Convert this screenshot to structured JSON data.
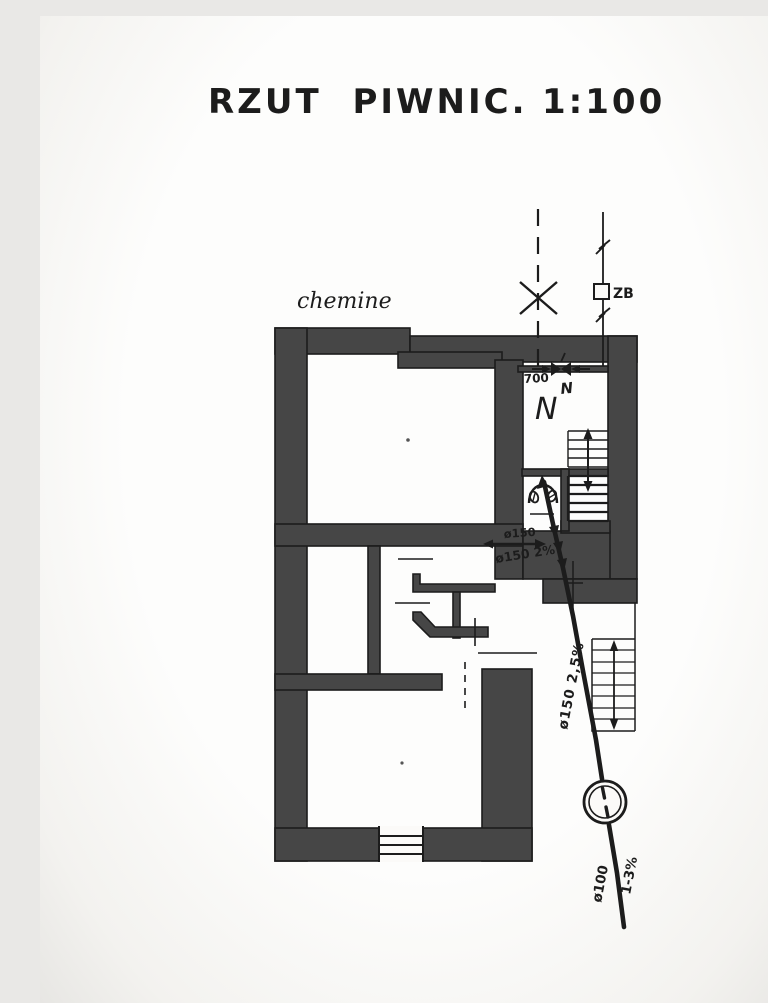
{
  "sheet": {
    "title": "RZUT PIWNIC.",
    "scale": "1:100"
  },
  "annotations": {
    "chimney": "chemine",
    "room_letter": "N",
    "valve_note": "N",
    "dimension": "700",
    "device": "ZB",
    "branch_diameter": "ø150",
    "branch_slope": "ø150 2%",
    "stack_label": "ø150  2,5%",
    "outlet_diameter": "ø100",
    "outlet_slope": "1-3%"
  },
  "colors": {
    "wall": "#464646",
    "ink": "#1c1c1c",
    "paper": "#fbfaf8"
  },
  "symbols": {
    "valve": "gate-valve-icon",
    "device_box": "zb-device-icon",
    "stack_cap": "x-cap-icon",
    "pipe_break": "pipe-break-icon",
    "chamber": "inspection-chamber-icon",
    "stair_arrow": "direction-arrow-icon"
  }
}
